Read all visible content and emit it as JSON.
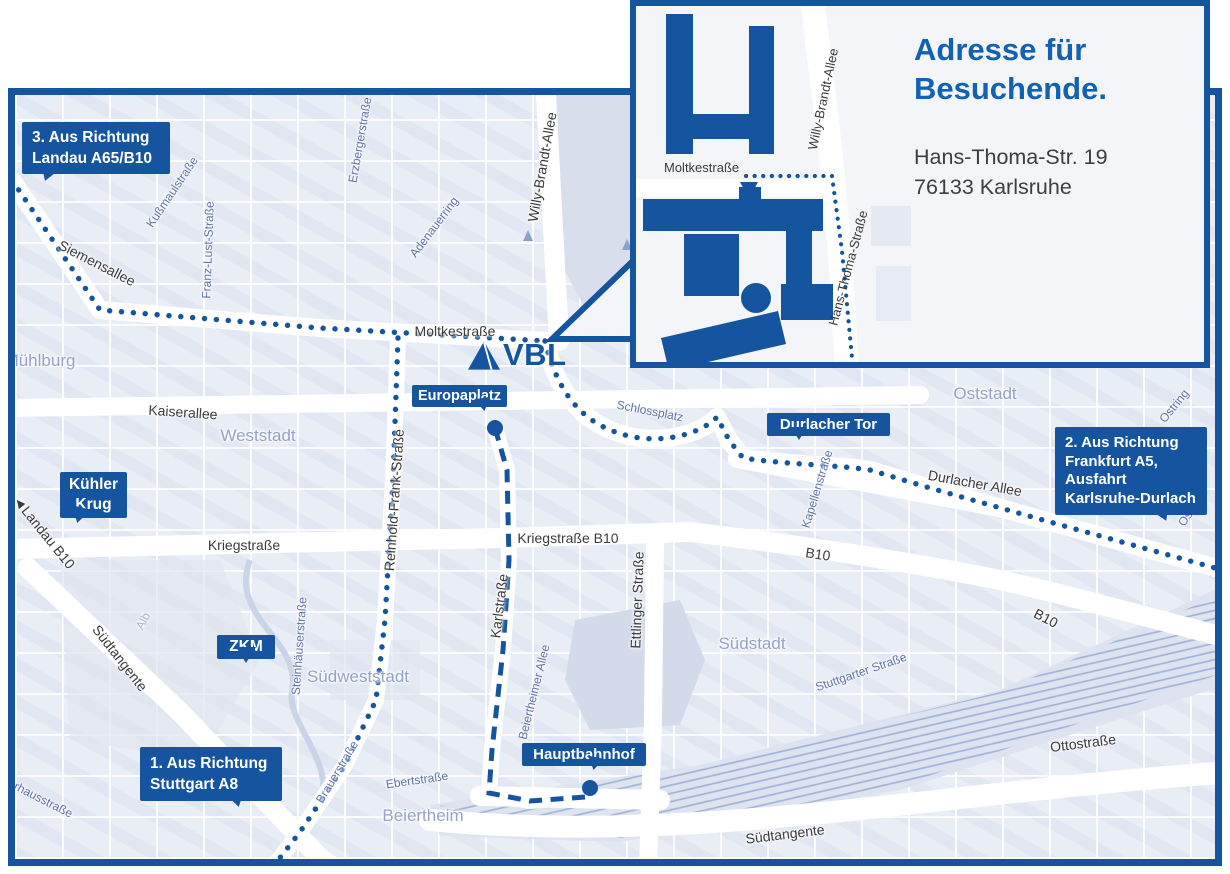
{
  "inset": {
    "title_line1": "Adresse für",
    "title_line2": "Besuchende.",
    "address_line1": "Hans-Thoma-Str. 19",
    "address_line2": "76133 Karlsruhe",
    "streets": {
      "moltkestrasse": "Moltkestraße",
      "willy_brandt_allee": "Willy-Brandt-Allee",
      "hans_thoma_strasse": "Hans-Thoma-Straße"
    }
  },
  "logo": {
    "text": "VBL"
  },
  "callouts": {
    "route3": {
      "line1": "3. Aus Richtung",
      "line2": "Landau A65/B10"
    },
    "route2": {
      "line1": "2. Aus Richtung",
      "line2": "Frankfurt A5,",
      "line3": "Ausfahrt",
      "line4": "Karlsruhe-Durlach"
    },
    "route1": {
      "line1": "1. Aus Richtung",
      "line2": "Stuttgart A8"
    },
    "kuehler_krug": {
      "line1": "Kühler",
      "line2": "Krug"
    },
    "zkm": {
      "line1": "ZKM"
    },
    "europaplatz": {
      "line1": "Europaplatz"
    },
    "durlacher_tor": {
      "line1": "Durlacher Tor"
    },
    "hauptbahnhof": {
      "line1": "Hauptbahnhof"
    }
  },
  "streets_major": {
    "siemensallee": "Siemensallee",
    "moltkestrasse": "Moltkestraße",
    "willy_brandt_allee": "Willy-Brandt-Allee",
    "kaiserallee": "Kaiserallee",
    "kriegstrasse": "Kriegstraße",
    "kriegstrasse_b10": "Kriegstraße B10",
    "reinhold_frank_strasse": "Reinhold-Frank-Straße",
    "karlstrasse": "Karlstraße",
    "ettlinger_strasse": "Ettlinger Straße",
    "durlacher_allee": "Durlacher Allee",
    "b10_a": "B10",
    "b10_b": "B10",
    "landau_b10_arrow": "◄",
    "landau_b10": "Landau B10",
    "suedtangente_west": "Südtangente",
    "suedtangente_sued": "Südtangente",
    "ottostrasse": "Ottostraße"
  },
  "streets_minor": {
    "kussmaulstrasse": "Kußmaulstraße",
    "franz_lust_strasse": "Franz-Lust-Straße",
    "erzbergerstrasse": "Erzbergerstraße",
    "adenauerring": "Adenauerring",
    "schlossplatz": "Schlossplatz",
    "kapellenstrasse": "Kapellenstraße",
    "stuttgarter_strasse": "Stuttgarter Straße",
    "steinhaeuserstrasse": "Steinhäuserstraße",
    "beiertheimer_allee": "Beiertheimer Allee",
    "brauerstrasse": "Brauerstraße",
    "ebertstrasse": "Ebertstraße",
    "pulverhausstrasse": "Pulverhausstraße",
    "ostring_a": "Ostring",
    "ostring_b": "Ostring",
    "alb": "Alb"
  },
  "districts": {
    "muehlburg": "Mühlburg",
    "weststadt": "Weststadt",
    "oststadt": "Oststadt",
    "suedstadt": "Südstadt",
    "suedweststadt": "Südweststadt",
    "beiertheim": "Beiertheim"
  },
  "colors": {
    "brand_blue": "#15549e",
    "title_blue": "#1261b2",
    "street_label_dark": "#3b3b3b",
    "street_label_map": "#6074a8",
    "district_label": "#95a3c8"
  }
}
